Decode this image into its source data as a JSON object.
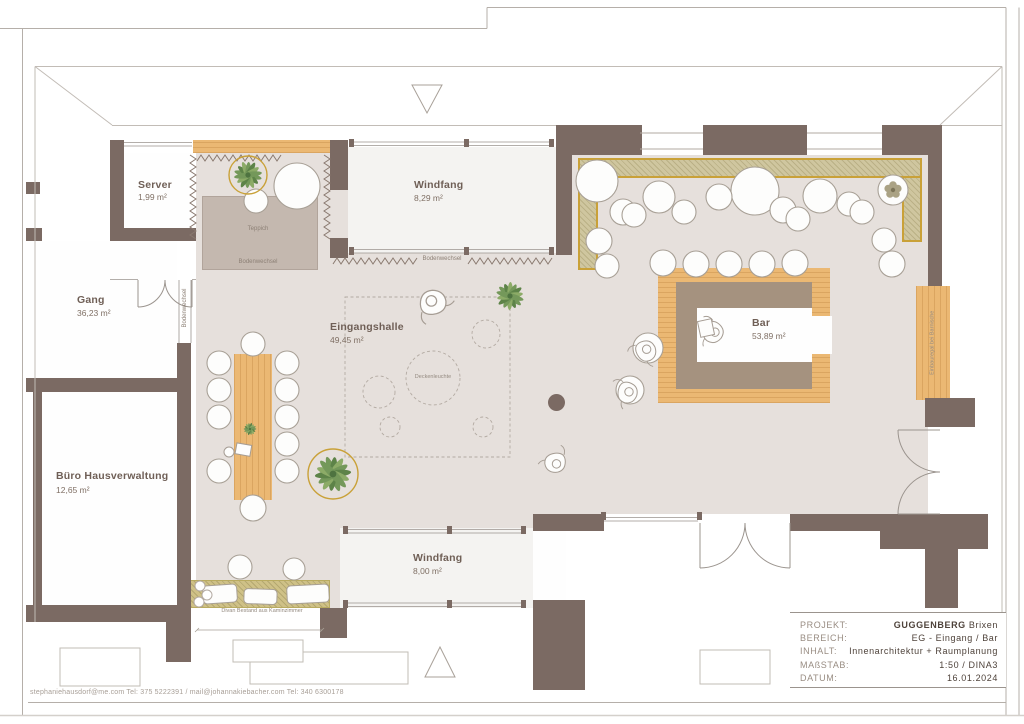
{
  "rooms": {
    "server": {
      "name": "Server",
      "area": "1,99 m²"
    },
    "windfang_top": {
      "name": "Windfang",
      "area": "8,29 m²"
    },
    "gang": {
      "name": "Gang",
      "area": "36,23 m²"
    },
    "eingangshalle": {
      "name": "Eingangshalle",
      "area": "49,45 m²"
    },
    "bar": {
      "name": "Bar",
      "area": "53,89 m²"
    },
    "buero": {
      "name": "Büro Hausverwaltung",
      "area": "12,65 m²"
    },
    "windfang_bottom": {
      "name": "Windfang",
      "area": "8,00 m²"
    }
  },
  "annotations": {
    "teppich": "Teppich",
    "bodenwechsel": "Bodenwechsel",
    "deckenleuchte": "Deckenleuchte",
    "divan": "Divan Bestand aus Kaminzimmer",
    "einbauregal": "Einbauregal bei Barnische"
  },
  "title_block": {
    "rows": [
      {
        "label": "PROJEKT:",
        "value_bold": "GUGGENBERG",
        "value": " Brixen"
      },
      {
        "label": "BEREICH:",
        "value": "EG - Eingang / Bar"
      },
      {
        "label": "INHALT:",
        "value": "Innenarchitektur + Raumplanung"
      },
      {
        "label": "MAßSTAB:",
        "value": "1:50 / DINA3"
      },
      {
        "label": "DATUM:",
        "value": "16.01.2024"
      }
    ]
  },
  "footer": {
    "contact": "stephaniehausdorf@me.com Tel: 375 5222391 / mail@johannakiebacher.com Tel: 340 6300178"
  },
  "palette": {
    "wall": "#7b6a63",
    "floor": "#e6e0dc",
    "floor_light": "#f4f3f1",
    "wood": "#ebb873",
    "rug": "#c4b8af",
    "bench": "#cfc69f",
    "bench_border": "#c9a138",
    "divan_rug": "#cfc187",
    "bar_counter_inner": "#a5927f",
    "plant_green": "#74985a"
  }
}
